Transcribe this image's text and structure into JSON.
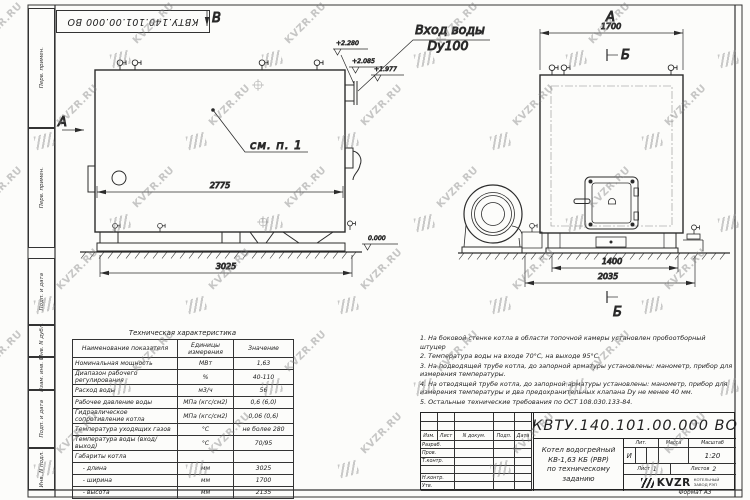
{
  "watermark": {
    "text": "KVZR.RU"
  },
  "stamp_top": "КВТУ.140.101.00.000  ВО",
  "side_strip": {
    "cells": [
      "Перв. примен.",
      "Перв. примен.",
      "Подп. и дата",
      "Инв. N дубл.",
      "Взам. инв. N",
      "Подп. и дата",
      "Инв. N подл."
    ]
  },
  "drawing": {
    "front": {
      "view_arrow_top": "В",
      "view_arrow_left": "А",
      "note_ref": "см. п. 1",
      "inlet_label_1": "Вход воды",
      "inlet_label_2": "Dy100",
      "dim_width": "2775",
      "dim_overall": "3025",
      "elev_1": "+2.280",
      "elev_2": "+2.085",
      "elev_3": "+1.977",
      "elev_zero": "0.000"
    },
    "side": {
      "view_label": "А",
      "section_top": "Б",
      "section_bottom": "Б",
      "dim_width": "1700",
      "dim_frame": "1400",
      "dim_overall": "2035"
    }
  },
  "tech_table": {
    "title": "Техническая характеристика",
    "headers": [
      "Наименование показателя",
      "Единицы измерения",
      "Значение"
    ],
    "rows": [
      [
        "Номинальная мощность",
        "МВт",
        "1,63"
      ],
      [
        "Диапазон рабочего регулирования",
        "%",
        "40-110"
      ],
      [
        "Расход воды",
        "м3/ч",
        "56"
      ],
      [
        "Рабочее давление воды",
        "МПа (кгс/см2)",
        "0,6 (6,0)"
      ],
      [
        "Гидравлическое сопротивление котла",
        "МПа (кгс/см2)",
        "0,06 (0,6)"
      ],
      [
        "Температура уходящих газов",
        "°С",
        "не более 280"
      ],
      [
        "Температура воды (вход/выход)",
        "°С",
        "70/95"
      ],
      [
        "Габариты котла",
        "",
        ""
      ],
      [
        "    - длина",
        "мм",
        "3025"
      ],
      [
        "    - ширина",
        "мм",
        "1700"
      ],
      [
        "    - высота",
        "мм",
        "2135"
      ]
    ]
  },
  "notes": {
    "items": [
      "1. На боковой стенке котла в области топочной камеры установлен пробоотборный штуцер",
      "2. Температура воды на входе 70°С, на выходе 95°С.",
      "3. На подводящей трубе котла, до запорной арматуры установлены: манометр, прибор для измерения температуры.",
      "4. На отводящей трубе котла, до запорной арматуры установлены: манометр, прибор для измерения температуры и два предохранительных клапана Dу не менее 40 мм.",
      "5. Остальные технические требования по ОСТ 108.030.133-84."
    ]
  },
  "title_block": {
    "doc_number": "КВТУ.140.101.00.000  ВО",
    "product_title_1": "Котел водогрейный",
    "product_title_2": "КВ-1,63 КБ (РВР)",
    "product_title_3": "по техническому заданию",
    "col_izm": "Изм.",
    "col_list": "Лист",
    "col_ndoc": "N докум.",
    "col_podp": "Подп.",
    "col_data": "Дата",
    "row_razrab": "Разраб.",
    "row_prov": "Пров.",
    "row_tkontr": "Т.контр.",
    "row_nkontr": "Н.контр.",
    "row_utv": "Утв.",
    "lit_header": "Лит.",
    "mass_header": "Масса",
    "scale_header": "Масштаб",
    "lit_value": "И",
    "scale_value": "1:20",
    "sheet_label": "Лист",
    "sheet_value": "1",
    "sheets_label": "Листов",
    "sheets_value": "2",
    "company_name": "KVZR",
    "company_line_1": "КОТЕЛЬНЫЙ",
    "company_line_2": "ЗАВОД РЭП",
    "format_label": "Формат   А3"
  }
}
